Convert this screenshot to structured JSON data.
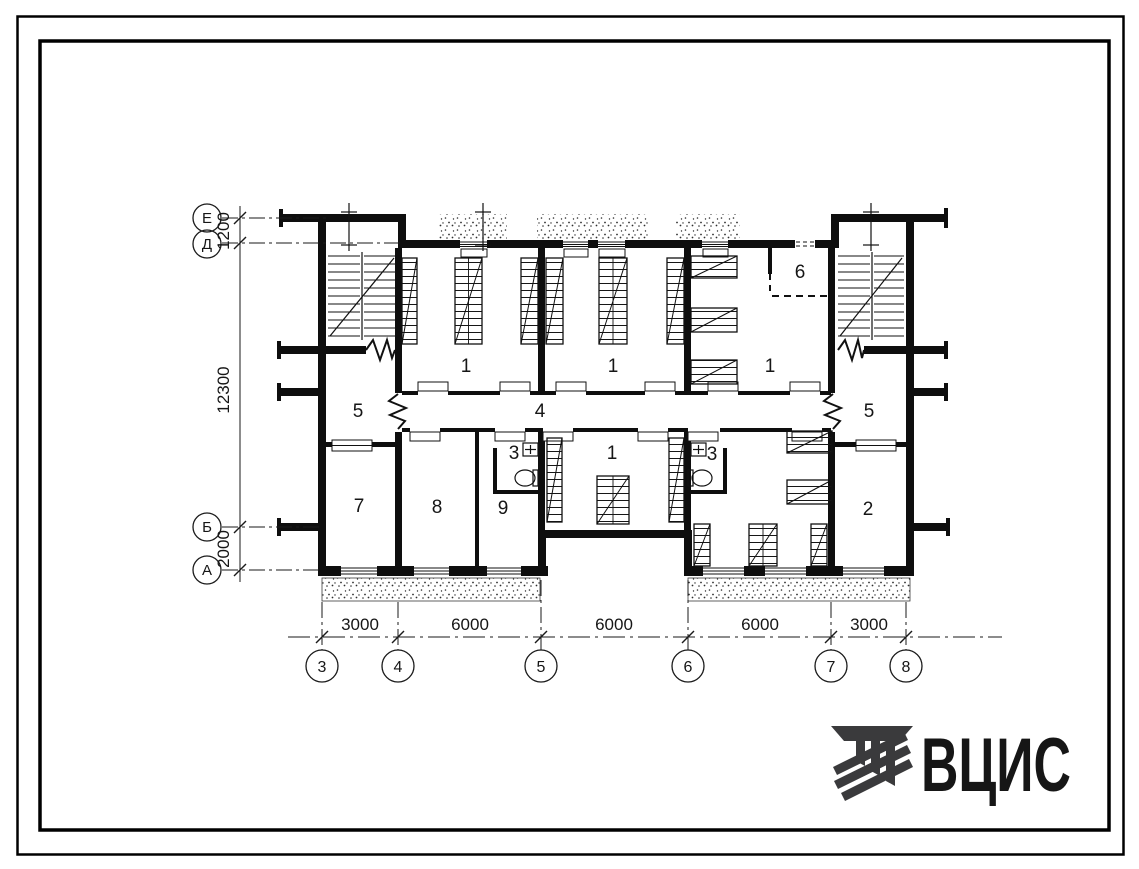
{
  "page": {
    "background": "#ffffff",
    "line_color": "#111111"
  },
  "plan": {
    "axes_left": [
      "Е",
      "Д",
      "Б",
      "А"
    ],
    "axes_bottom": [
      "3",
      "4",
      "5",
      "6",
      "7",
      "8"
    ],
    "dims_left": [
      "1200",
      "12300",
      "2000"
    ],
    "dims_bottom": [
      "3000",
      "6000",
      "6000",
      "6000",
      "3000"
    ],
    "rooms": {
      "r1_left": "1",
      "r1_mid": "1",
      "r1_right": "1",
      "r1_lower": "1",
      "r5_left": "5",
      "r5_right": "5",
      "corridor": "4",
      "r3_left": "3",
      "r3_right": "3",
      "r7": "7",
      "r8": "8",
      "r9": "9",
      "r2": "2",
      "r6": "6"
    }
  },
  "logo": {
    "text": "ВЦИС",
    "color": "#3a3a3c"
  }
}
